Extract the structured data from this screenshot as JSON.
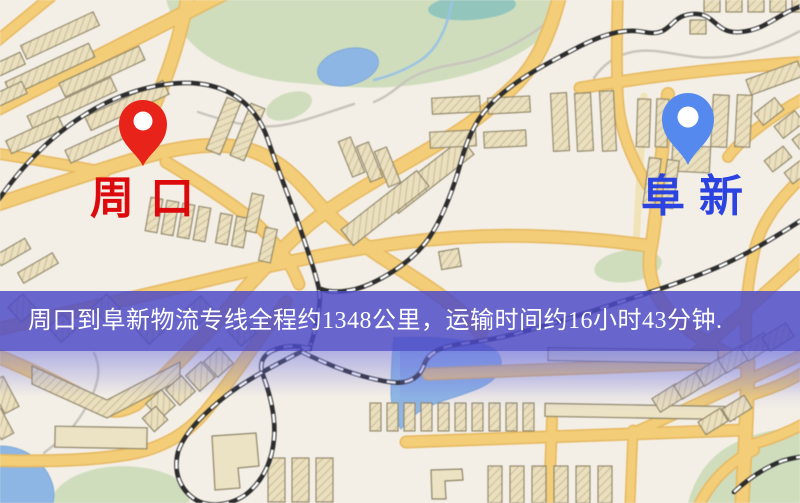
{
  "banner": {
    "text": "周口到阜新物流专线全程约1348公里，运输时间约16小时43分钟.",
    "background": "rgba(76,74,199,0.84)",
    "text_color": "#ffffff"
  },
  "markers": {
    "origin": {
      "label": "周口",
      "label_color": "#dd0a0d",
      "pin_color": "#e8231a"
    },
    "destination": {
      "label": "阜新",
      "label_color": "#2b43e0",
      "pin_color": "#5589ee"
    }
  },
  "map_palette": {
    "background": "#f4efe6",
    "road": "#f2cd79",
    "road_casing": "#e5b863",
    "road_minor": "#f0e3b8",
    "building": "#eadfc0",
    "building_outline": "#8d8468",
    "park": "#cfddbe",
    "water": "#8fb6e3",
    "water_teal": "#93c6bd",
    "railway_dark": "#2d2d2d",
    "railway_light": "#ffffff",
    "path_gray": "#c9c5bc"
  }
}
